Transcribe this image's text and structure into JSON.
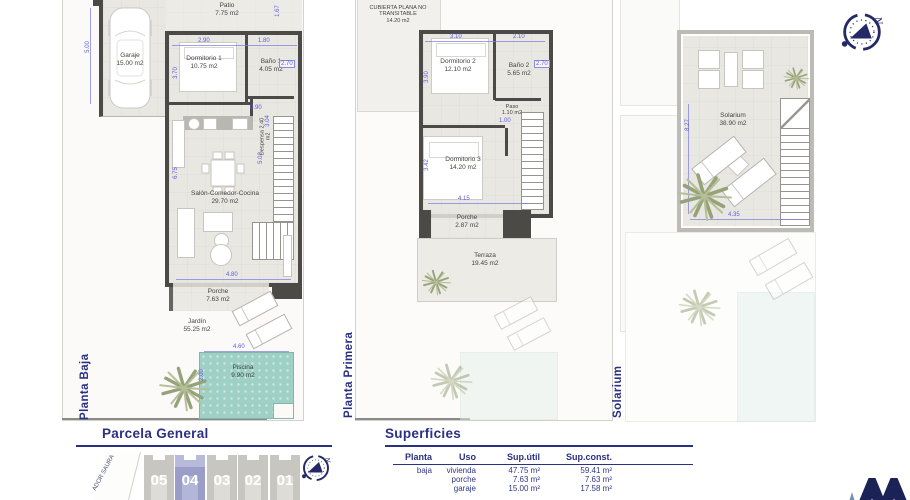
{
  "colors": {
    "navy": "#2a3182",
    "dim_blue": "#5f5fd8",
    "wall": "#4b4a47",
    "floor": "#e9e7e1",
    "pool": "#9ed0c6",
    "plot_gray": "#c7c6c1",
    "plot_highlight": "#9a9dc8"
  },
  "north": {
    "letter": "N"
  },
  "plan_baja": {
    "title": "Planta Baja",
    "rooms": {
      "patio": {
        "name": "Patio",
        "area": "7.75 m2"
      },
      "garaje": {
        "name": "Garaje",
        "area": "15.00 m2"
      },
      "dorm1": {
        "name": "Dormitorio 1",
        "area": "10.75 m2"
      },
      "bano1": {
        "name": "Baño 1",
        "area": "4.05 m2"
      },
      "despensa": {
        "name": "Despensa 2.40 m2"
      },
      "salon": {
        "name": "Salón-Comedor-Cocina",
        "area": "29.70 m2"
      },
      "porche": {
        "name": "Porche",
        "area": "7.63 m2"
      },
      "jardin": {
        "name": "Jardín",
        "area": "55.25 m2"
      },
      "piscina": {
        "name": "Piscina",
        "area": "9.90 m2"
      }
    },
    "dims": {
      "garage_h": "5.00",
      "patio_r": "1.67",
      "dorm1_w": "2.90",
      "bath_w": "1.80",
      "dorm1_h": "3.70",
      "bath_d": "2.70",
      "hall": "0.90",
      "stair_w": "3.04",
      "stair_h": "5.02",
      "salon_h": "6.75",
      "salon_w": "4.80",
      "pool_w": "4.60",
      "pool_h": "2.00"
    }
  },
  "plan_primera": {
    "title": "Planta Primera",
    "rooms": {
      "cubierta": {
        "name": "CUBIERTA PLANA NO TRANSITABLE",
        "area": "14.20 m2"
      },
      "dorm2": {
        "name": "Dormitorio 2",
        "area": "12.10 m2"
      },
      "bano2": {
        "name": "Baño 2",
        "area": "5.65 m2"
      },
      "paso": {
        "name": "Paso",
        "area": "1.10 m2"
      },
      "dorm3": {
        "name": "Dormitorio 3",
        "area": "14.20 m2"
      },
      "porche": {
        "name": "Porche",
        "area": "2.87 m2"
      },
      "terraza": {
        "name": "Terraza",
        "area": "19.45 m2"
      }
    },
    "dims": {
      "dorm2_w": "3.10",
      "bath2_w": "2.10",
      "dorm2_h": "3.90",
      "bath2_d": "2.70",
      "paso_w": "1.00",
      "dorm3_h": "3.42",
      "dorm3_w": "4.15"
    }
  },
  "plan_solarium": {
    "title": "Solarium",
    "rooms": {
      "solarium": {
        "name": "Solarium",
        "area": "38.90 m2"
      }
    },
    "dims": {
      "height": "8.27",
      "width": "4.35"
    }
  },
  "parcela": {
    "heading": "Parcela General",
    "street": "ADOR SAURA",
    "plots": [
      "05",
      "04",
      "03",
      "02",
      "01"
    ]
  },
  "superficies": {
    "heading": "Superficies",
    "headers": {
      "planta": "Planta",
      "uso": "Uso",
      "util": "Sup.útil",
      "const": "Sup.const."
    },
    "col_planta": [
      "baja",
      "",
      ""
    ],
    "col_uso": [
      "vivienda",
      "porche",
      "garaje"
    ],
    "col_util": [
      "47.75 m²",
      "7.63 m²",
      "15.00 m²"
    ],
    "col_const": [
      "59.41 m²",
      "7.63 m²",
      "17.58 m²"
    ]
  }
}
